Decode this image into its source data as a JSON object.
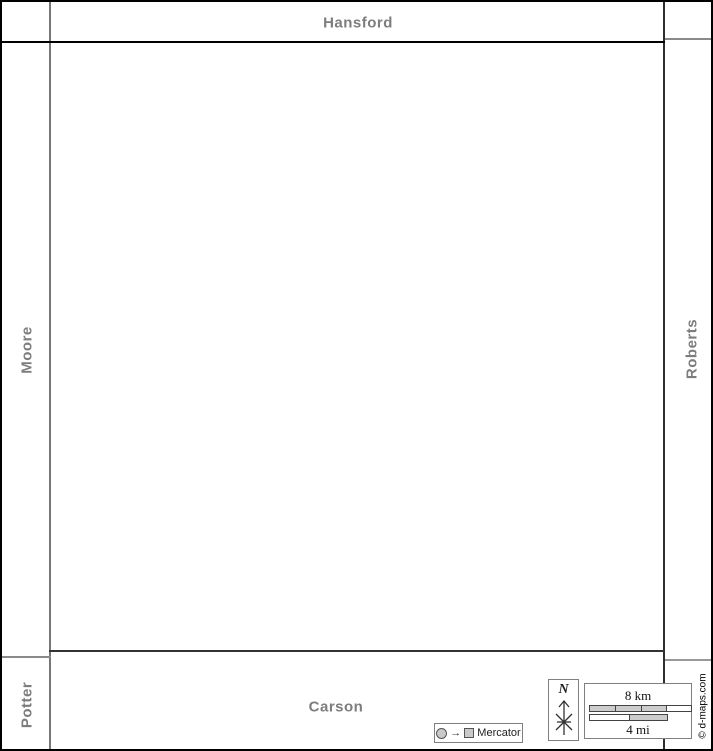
{
  "neighbors": {
    "top": "Hansford",
    "left": "Moore",
    "right": "Roberts",
    "bottom": "Carson",
    "bottom_left": "Potter"
  },
  "compass": {
    "north_label": "N"
  },
  "scale": {
    "km_label": "8 km",
    "mi_label": "4 mi"
  },
  "projection": {
    "arrow": "→",
    "label": "Mercator"
  },
  "credit": "© d-maps.com",
  "colors": {
    "neighbor_label": "#7d7d7d",
    "outer_border": "#000000",
    "county_border_dark": "#2e2e2e",
    "separator_gray": "#8a8a8a",
    "scalebar_fill": "#cccccc",
    "panel_border": "#808080",
    "background": "#ffffff"
  }
}
